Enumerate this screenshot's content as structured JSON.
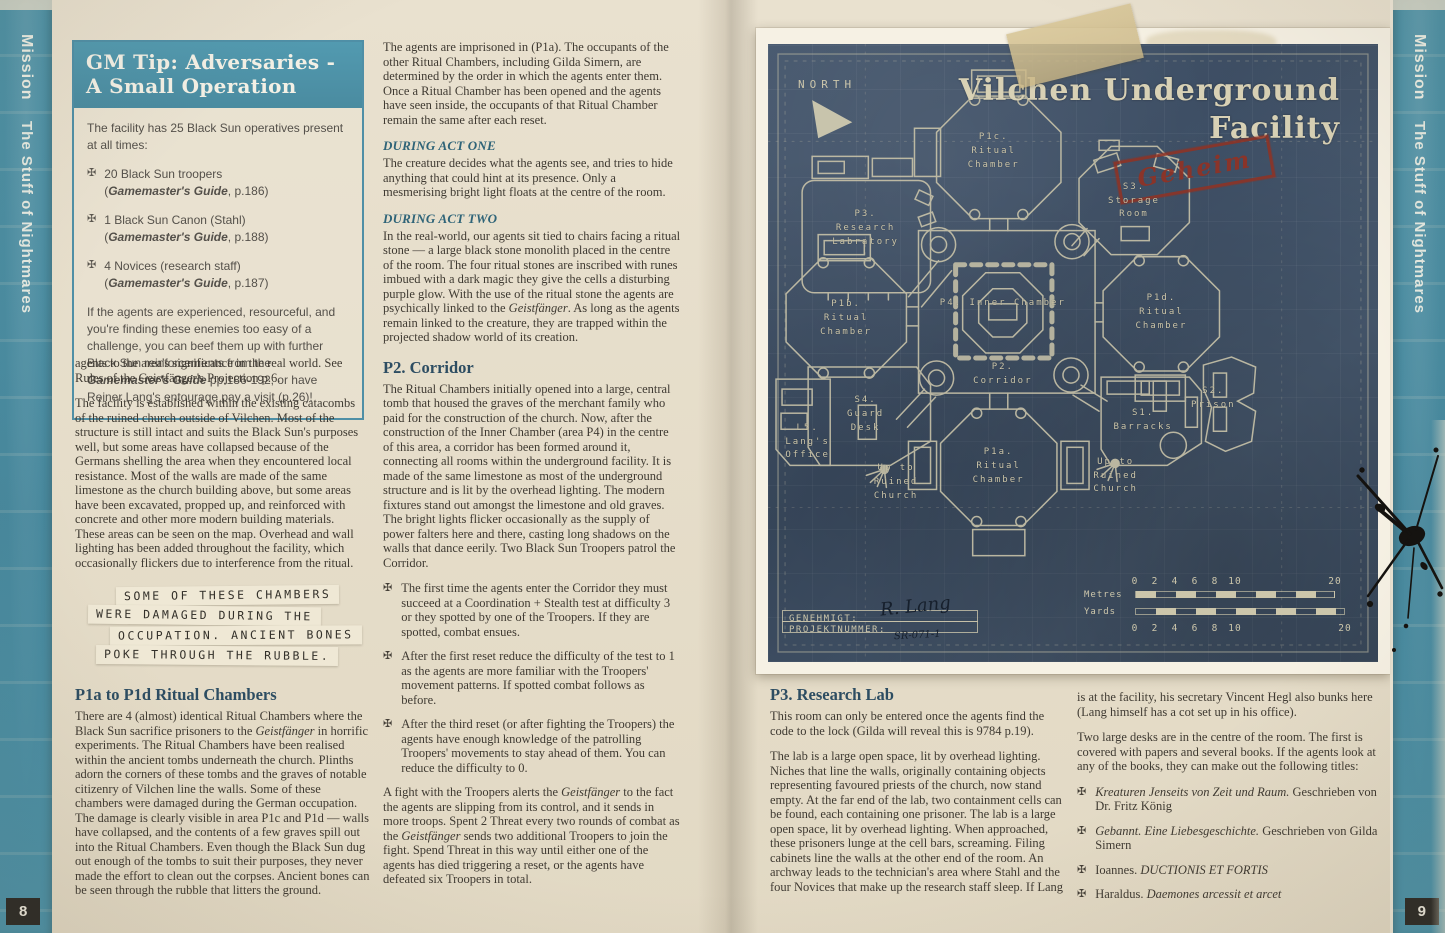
{
  "icons": {
    "bullet_cross": "✠"
  },
  "left_sidebar": {
    "section": "Mission",
    "title": "The Stuff of Nightmares",
    "page_number": "8"
  },
  "right_sidebar": {
    "section": "Mission",
    "title": "The Stuff of Nightmares",
    "page_number": "9"
  },
  "gm_tip": {
    "title_line1": "GM Tip: Adversaries -",
    "title_line2": "A Small Operation",
    "intro": "The facility has 25 Black Sun operatives present at all times:",
    "bullets": [
      {
        "text": "20 Black Sun troopers",
        "ref_pre": "(",
        "ref_book": "Gamemaster's Guide",
        "ref_post": ", p.186)"
      },
      {
        "text": "1 Black Sun Canon (Stahl)",
        "ref_pre": "(",
        "ref_book": "Gamemaster's Guide",
        "ref_post": ", p.188)"
      },
      {
        "text": "4 Novices (research staff)",
        "ref_pre": "(",
        "ref_book": "Gamemaster's Guide",
        "ref_post": ", p.187)"
      }
    ],
    "outro_1": "If the agents are experienced, resourceful, and you're finding these enemies too easy of a challenge, you can beef them up with further Black Sun reinforcements from the ",
    "outro_book": "Gamemaster's Guide",
    "outro_2": " pp.186-192, or have Reiner Lang's entourage pay a visit (p.26)!"
  },
  "left_column": {
    "para1": "agents to the area's significance in the real world. See Rules of the Geistfänger's Projection p.6.",
    "para2": "The facility is established within the existing catacombs of the ruined church outside of Vilchen. Most of the structure is still intact and suits the Black Sun's purposes well, but some areas have collapsed because of the Germans shelling the area when they encountered local resistance. Most of the walls are made of the same limestone as the church building above, but some areas have been excavated, propped up, and reinforced with concrete and other more modern building materials. These areas can be seen on the map. Overhead and wall lighting has been added throughout the facility, which occasionally flickers due to interference from the ritual."
  },
  "typewriter_lines": [
    "SOME OF THESE CHAMBERS",
    "WERE DAMAGED DURING THE",
    "OCCUPATION. ANCIENT BONES",
    "POKE THROUGH THE RUBBLE."
  ],
  "p1a_section": {
    "heading": "P1a to P1d Ritual Chambers",
    "t1": "There are 4 (almost) identical Ritual Chambers where the Black Sun sacrifice prisoners to the ",
    "em1": "Geistfänger",
    "t2": " in horrific experiments. The Ritual Chambers have been realised within the ancient tombs underneath the church. Plinths adorn the corners of these tombs and the graves of notable citizenry of Vilchen line the walls. Some of these chambers were damaged during the German occupation. The damage is clearly visible in area P1c and P1d — walls have collapsed, and the contents of a few graves spill out into the Ritual Chambers. Even though the Black Sun dug out enough of the tombs to suit their purposes, they never made the effort to clean out the corpses. Ancient bones can be seen through the rubble that litters the ground."
  },
  "mid_column": {
    "para1": "The agents are imprisoned in (P1a). The occupants of the other Ritual Chambers, including Gilda Simern, are determined by the order in which the agents enter them. Once a Ritual Chamber has been opened and the agents have seen inside, the occupants of that Ritual Chamber remain the same after each reset.",
    "act_one_heading": "DURING ACT ONE",
    "act_one_text": "The creature decides what the agents see, and tries to hide anything that could hint at its presence. Only a mesmerising bright light floats at the centre of the room.",
    "act_two_heading": "DURING ACT TWO",
    "act_two_t1": "In the real-world, our agents sit tied to chairs facing a ritual stone — a large black stone monolith placed in the centre of the room. The four ritual stones are inscribed with runes imbued with a dark magic they give the cells a disturbing purple glow. With the use of the ritual stone the agents are psychically linked to the ",
    "act_two_em": "Geistfänger",
    "act_two_t2": ". As long as the agents remain linked to the creature, they are trapped within the projected shadow world of its creation.",
    "p2_heading": "P2. Corridor",
    "p2_text": "The Ritual Chambers initially opened into a large, central tomb that housed the graves of the merchant family who paid for the construction of the church. Now, after the construction of the Inner Chamber (area P4) in the centre of this area, a corridor has been formed around it, connecting all rooms within the underground facility. It is made of the same limestone as most of the underground structure and is lit by the overhead lighting. The modern fixtures stand out amongst the limestone and old graves. The bright lights flicker occasionally as the supply of power falters here and there, casting long shadows on the walls that dance eerily. Two Black Sun Troopers patrol the Corridor.",
    "bullet1": "The first time the agents enter the Corridor they must succeed at a Coordination + Stealth test at difficulty 3 or they spotted by one of the Troopers. If they are spotted, combat ensues.",
    "bullet2": "After the first reset reduce the difficulty of the test to 1 as the agents are more familiar with the Troopers' movement patterns. If spotted combat follows as before.",
    "bullet3": "After the third reset (or after fighting the Troopers) the agents have enough knowledge of the patrolling Troopers' movements to stay ahead of them. You can reduce the difficulty to 0.",
    "fight_t1": "A fight with the Troopers alerts the ",
    "fight_em1": "Geistfänger",
    "fight_t2": " to the fact the agents are slipping from its control, and it sends in more troops. Spent 2 Threat every two rounds of combat as the ",
    "fight_em2": "Geistfänger",
    "fight_t3": " sends two additional Troopers to join the fight. Spend Threat in this way until either one of the agents has died triggering a reset, or the agents have defeated six Troopers in total."
  },
  "p3_section": {
    "heading": "P3. Research Lab",
    "para1": "This room can only be entered once the agents find the code to the lock (Gilda will reveal this is 9784 p.19).",
    "para2": "The lab is a large open space, lit by overhead lighting. Niches that line the walls, originally containing objects representing favoured priests of the church, now stand empty. At the far end of the lab, two containment cells can be found, each containing one prisoner. The lab is a large open space, lit by overhead lighting. When approached, these prisoners lunge at the cell bars, screaming. Filing cabinets line the walls at the other end of the room. An archway leads to the technician's area where Stahl and the four Novices that make up the research staff sleep. If Lang"
  },
  "right_column": {
    "para1": "is at the facility, his secretary Vincent Hegl also bunks here (Lang himself has a cot set up in his office).",
    "para2": "Two large desks are in the centre of the room. The first is covered with papers and several books. If the agents look at any of the books, they can make out the following titles:",
    "books": [
      {
        "roman_before": "",
        "italic": "Kreaturen Jenseits von Zeit und Raum.",
        "roman_after": " Geschrieben von Dr. Fritz König"
      },
      {
        "roman_before": "",
        "italic": "Gebannt. Eine Liebesgeschichte.",
        "roman_after": " Geschrieben von Gilda Simern"
      },
      {
        "roman_before": "Ioannes. ",
        "italic": "DUCTIONIS ET FORTIS",
        "roman_after": ""
      },
      {
        "roman_before": "Haraldus. ",
        "italic": "Daemones arcessit et arcet",
        "roman_after": ""
      }
    ]
  },
  "blueprint": {
    "title_line1": "Vilchen Underground",
    "title_line2": "Facility",
    "stamp": "Geheim",
    "north_label": "NORTH",
    "rooms": [
      {
        "id": "p1c",
        "label": "P1c.\nRitual\nChamber"
      },
      {
        "id": "p3",
        "label": "P3.\nResearch\nLabratory"
      },
      {
        "id": "s3",
        "label": "S3.\nStorage\nRoom"
      },
      {
        "id": "p1b",
        "label": "P1b.\nRitual\nChamber"
      },
      {
        "id": "p4",
        "label": "P4. Inner Chamber"
      },
      {
        "id": "p1d",
        "label": "P1d.\nRitual\nChamber"
      },
      {
        "id": "p2",
        "label": "P2.\nCorridor"
      },
      {
        "id": "s4",
        "label": "S4.\nGuard\nDesk"
      },
      {
        "id": "l5",
        "label": "L5.\nLang's\nOffice"
      },
      {
        "id": "up_left",
        "label": "Up to\nRuined\nChurch"
      },
      {
        "id": "p1a",
        "label": "P1a.\nRitual\nChamber"
      },
      {
        "id": "s1",
        "label": "S1.\nBarracks"
      },
      {
        "id": "s2",
        "label": "S2.\nPrison"
      },
      {
        "id": "up_right",
        "label": "Up to\nRuined\nChurch"
      }
    ],
    "scale": {
      "metres_label": "Metres",
      "yards_label": "Yards",
      "ticks": [
        "0",
        "2",
        "4",
        "6",
        "8",
        "10"
      ],
      "end_tick": "20"
    },
    "approval": {
      "genehmigt_label": "GENEHMIGT:",
      "genehmigt_value": "R. Lang",
      "projekt_label": "PROJEKTNUMMER:",
      "projekt_value": "SR-071-1"
    }
  }
}
